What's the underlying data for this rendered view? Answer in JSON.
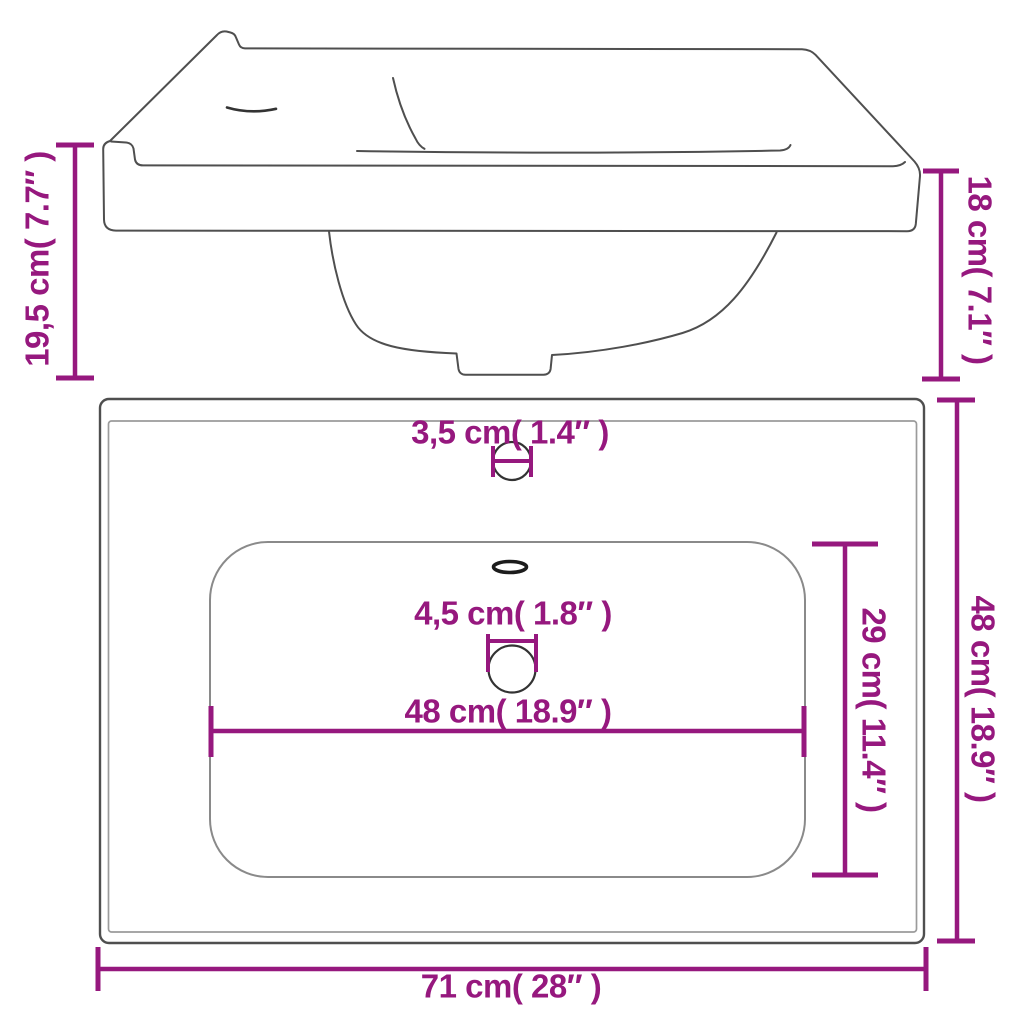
{
  "page": {
    "title": "Bathroom sink dimension diagram",
    "background": "#ffffff"
  },
  "colors": {
    "accent": "#96187E",
    "outline": "#4f4f4f",
    "inner_border": "#9b9b9b",
    "basin_line": "#8a8a8a",
    "hole_line": "#333333"
  },
  "views": {
    "side_view": "sink side elevation with bowl profile",
    "top_view": "sink top plan with basin, faucet hole, overflow and drain"
  },
  "labels": {
    "side_height_total": "19,5 cm( 7.7″ )",
    "side_height_right": "18 cm( 7.1″ )",
    "faucet_hole_diameter": "3,5 cm( 1.4″ )",
    "drain_hole_diameter": "4,5 cm( 1.8″ )",
    "basin_width": "48 cm( 18.9″ )",
    "basin_depth": "29 cm( 11.4″ )",
    "overall_depth": "48 cm( 18.9″ )",
    "overall_width": "71 cm( 28″ )"
  }
}
